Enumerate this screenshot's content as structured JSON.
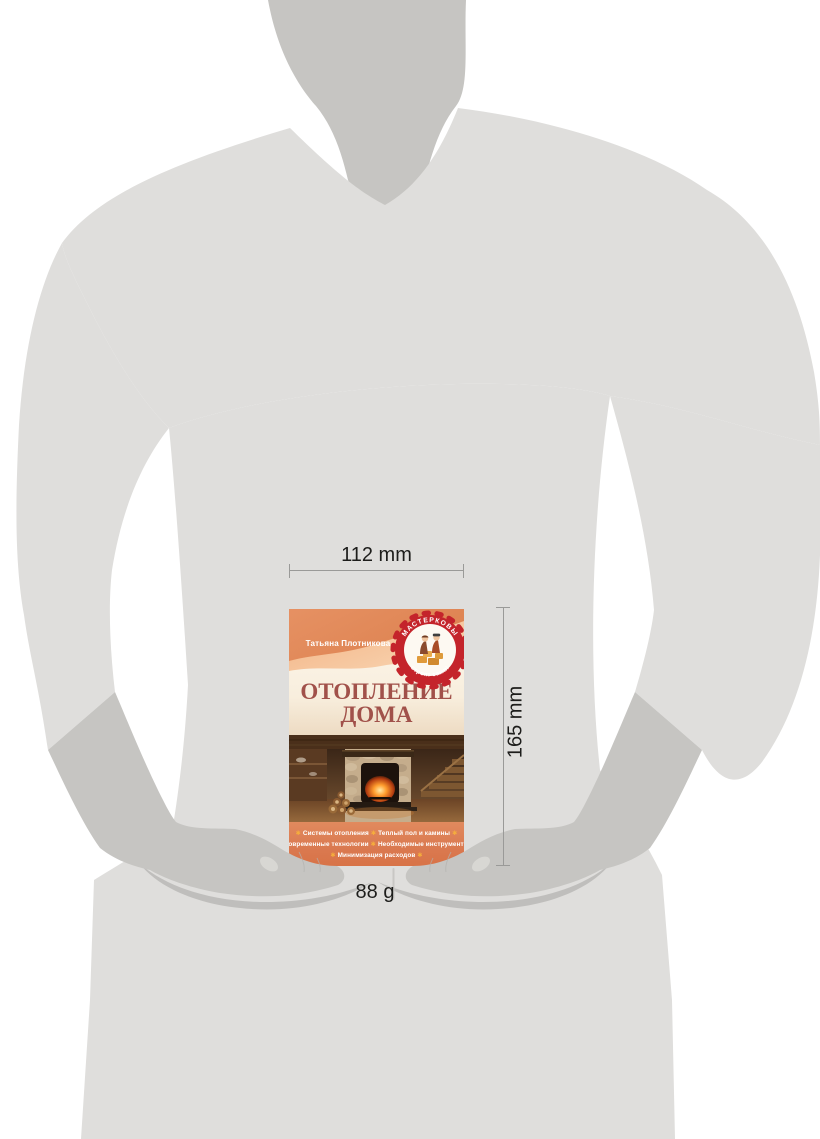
{
  "annotations": {
    "width_label": "112 mm",
    "height_label": "165 mm",
    "weight_label": "88 g"
  },
  "book": {
    "author": "Татьяна Плотникова",
    "title": [
      "ОТОПЛЕНИЕ",
      "ДОМА"
    ],
    "badge": {
      "top": "МАСТЕРКОВЫ",
      "bottom": "строят сами!"
    },
    "features": {
      "separator": "✱",
      "items": [
        "Системы отопления",
        "Теплый пол и камины",
        "Современные технологии",
        "Необходимые инструменты",
        "Минимизация расходов"
      ]
    }
  },
  "colors": {
    "body_gray": "#dfdedc",
    "skin_gray": "#c6c5c2",
    "shadow_gray": "#bab9b6",
    "badge_red": "#c4242b",
    "title_red": "#a1514a",
    "band_orange_dark": "#df8a58",
    "band_orange_light": "#f6cba6",
    "bottom_band_orange": "#dc7e53",
    "star_yellow": "#f6ae3c",
    "cream": "#faf1e2",
    "background": "#ffffff"
  }
}
